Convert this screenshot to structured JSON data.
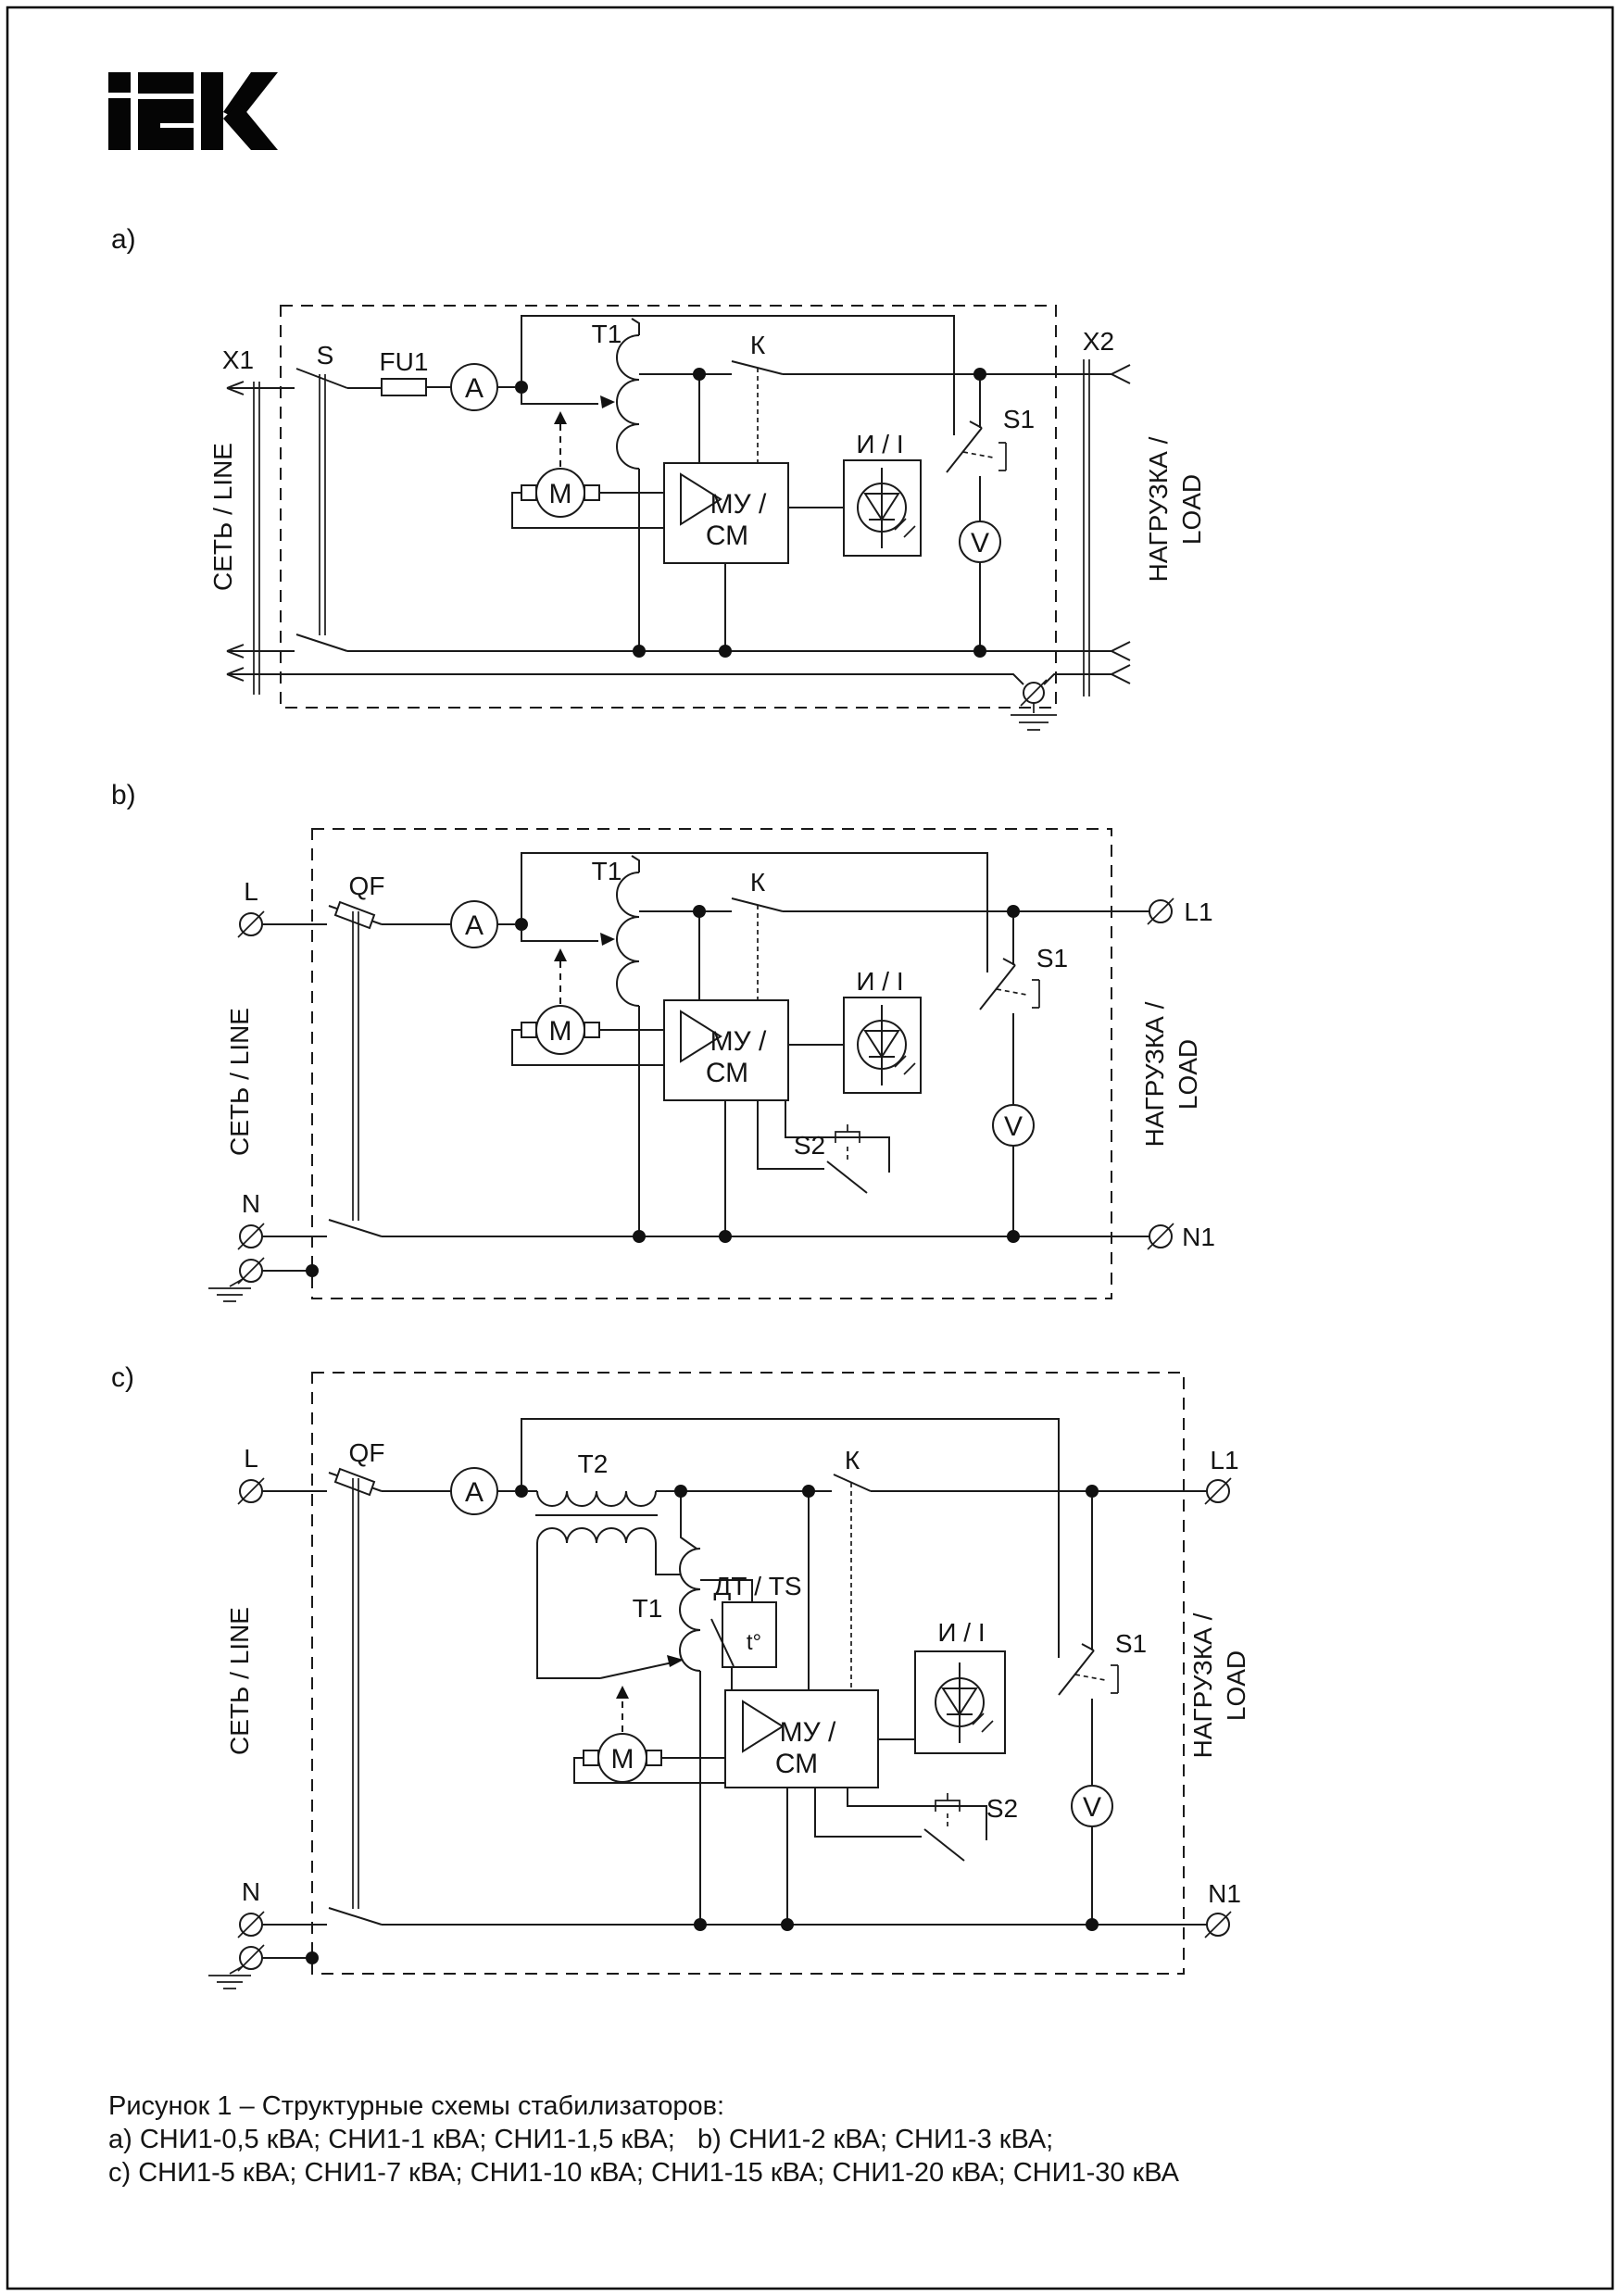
{
  "page": {
    "logo_text": "IEK"
  },
  "diagrams": {
    "a": {
      "fig": "a)",
      "x1": "X1",
      "net": "СЕТЬ / LINE",
      "s": "S",
      "fu1": "FU1",
      "ammeter": "A",
      "t1": "Т1",
      "k": "К",
      "motor": "М",
      "mu_line1": "МУ /",
      "mu_line2": "СМ",
      "indicator": "И / I",
      "s1": "S1",
      "voltmeter": "V",
      "x2": "X2",
      "load1": "НАГРУЗКА /",
      "load2": "LOAD"
    },
    "b": {
      "fig": "b)",
      "l": "L",
      "n": "N",
      "qf": "QF",
      "ammeter": "A",
      "t1": "Т1",
      "k": "К",
      "motor": "М",
      "mu_line1": "МУ /",
      "mu_line2": "СМ",
      "indicator": "И / I",
      "s1": "S1",
      "s2": "S2",
      "voltmeter": "V",
      "l1": "L1",
      "n1": "N1",
      "net": "СЕТЬ / LINE",
      "load1": "НАГРУЗКА /",
      "load2": "LOAD"
    },
    "c": {
      "fig": "c)",
      "l": "L",
      "n": "N",
      "qf": "QF",
      "ammeter": "A",
      "t1": "Т1",
      "t2": "Т2",
      "dt": "ДТ / TS",
      "tdeg": "t°",
      "k": "К",
      "motor": "М",
      "mu_line1": "МУ /",
      "mu_line2": "СМ",
      "indicator": "И / I",
      "s1": "S1",
      "s2": "S2",
      "voltmeter": "V",
      "l1": "L1",
      "n1": "N1",
      "net": "СЕТЬ / LINE",
      "load1": "НАГРУЗКА /",
      "load2": "LOAD"
    }
  },
  "caption": {
    "line1": "Рисунок 1 – Структурные схемы стабилизаторов:",
    "line2": "a) СНИ1-0,5 кВА; СНИ1-1 кВА; СНИ1-1,5 кВА;   b) СНИ1-2 кВА; СНИ1-3 кВА;",
    "line3": "c) СНИ1-5 кВА; СНИ1-7 кВА; СНИ1-10 кВА; СНИ1-15 кВА; СНИ1-20 кВА; СНИ1-30 кВА"
  }
}
